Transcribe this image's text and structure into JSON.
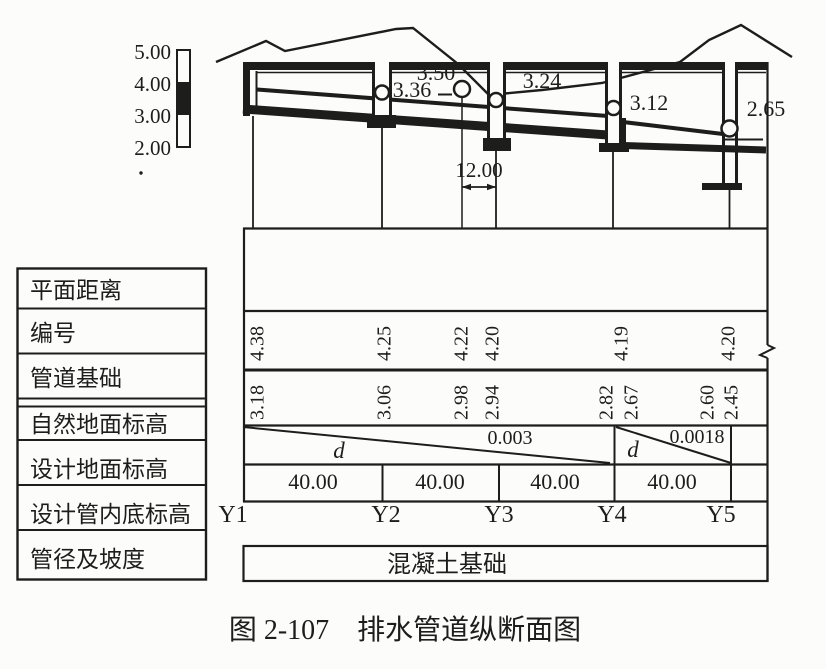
{
  "figure": {
    "caption": "图 2-107　排水管道纵断面图",
    "colors": {
      "ink": "#1d1d1b",
      "paper": "#fcfcfa"
    },
    "scale_bar": {
      "labels": [
        "5.00",
        "4.00",
        "3.00",
        "2.00"
      ]
    },
    "profile": {
      "labels": {
        "crossing_top": "3.50",
        "crossing_bottom": "3.36",
        "y3_crown": "3.24",
        "y4_crown": "3.12",
        "y5_crown": "2.65"
      },
      "dimension": "12.00"
    },
    "table": {
      "row_headers": [
        "平面距离",
        "编号",
        "管道基础",
        "自然地面标高",
        "设计地面标高",
        "设计管内底标高",
        "管径及坡度"
      ],
      "natural_ground": [
        "4.38",
        "4.25",
        "4.22",
        "4.20",
        "4.19",
        "4.20"
      ],
      "invert": [
        "3.18",
        "3.06",
        "2.98",
        "2.94",
        "2.82",
        "2.67",
        "2.60",
        "2.45"
      ],
      "slopes": [
        {
          "symbol": "d",
          "value": "0.003"
        },
        {
          "symbol": "d",
          "value": "0.0018"
        }
      ],
      "distances": [
        "40.00",
        "40.00",
        "40.00",
        "40.00"
      ],
      "stations": [
        "Y1",
        "Y2",
        "Y3",
        "Y4",
        "Y5"
      ],
      "foundation": "混凝土基础"
    }
  }
}
